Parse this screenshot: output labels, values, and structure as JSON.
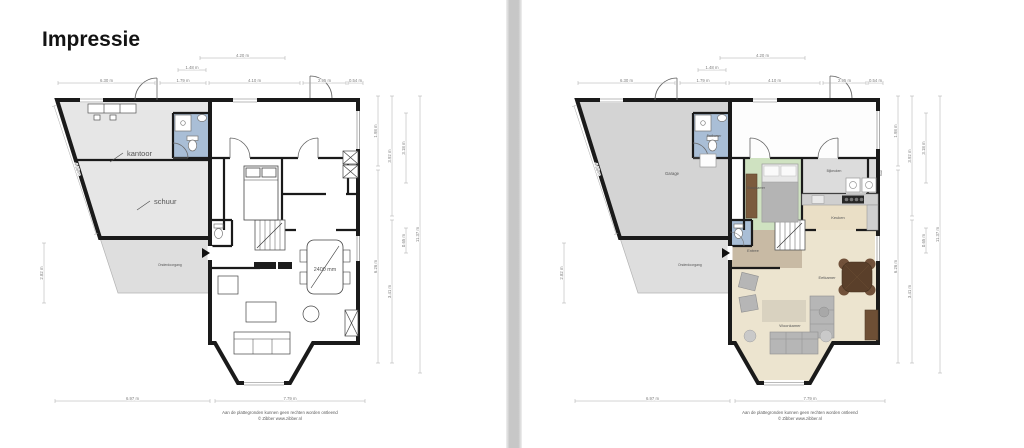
{
  "title": "Impressie",
  "footer": {
    "line1": "Aan de plattegronden kunnen geen rechten worden ontleend",
    "line2": "© Zibber www.zibber.nl"
  },
  "colors": {
    "wall": "#1a1a1a",
    "bathroom_blue": "#a9bed6",
    "bedroom_green": "#cfe2c1",
    "garage_gray": "#d4d4d4",
    "wing_gray_bw": "#e6e6e6",
    "utility_gray": "#dcdcdc",
    "kitchen_beige": "#eadfc6",
    "living_beige": "#ece4cf",
    "entree_taupe": "#c8baa4",
    "underpass_gray": "#dedede",
    "wood_brown": "#5a3f2a"
  },
  "plans": {
    "left": {
      "style": "black-and-white",
      "labels": [
        {
          "text": "kantoor",
          "x": 97,
          "y": 108,
          "size": 7.5,
          "color": "#333",
          "leader": [
            80,
            114,
            93,
            105
          ]
        },
        {
          "text": "schuur",
          "x": 124,
          "y": 156,
          "size": 7.5,
          "color": "#333",
          "leader": [
            107,
            162,
            120,
            153
          ]
        },
        {
          "text": "Onderdoorgang",
          "x": 128,
          "y": 218,
          "size": 3.4,
          "color": "#8a8a8a"
        },
        {
          "text": "2400 mm",
          "x": 295,
          "y": 223,
          "size": 5.4,
          "color": "#444",
          "anchor": "middle"
        }
      ],
      "dimensions": [
        {
          "x1": 170,
          "y1": 10,
          "x2": 255,
          "y2": 10,
          "label": "4.20 m"
        },
        {
          "x1": 148,
          "y1": 22,
          "x2": 176,
          "y2": 22,
          "label": "1.48 m"
        },
        {
          "x1": 28,
          "y1": 35,
          "x2": 125,
          "y2": 35,
          "label": "6.30 m"
        },
        {
          "x1": 130,
          "y1": 35,
          "x2": 176,
          "y2": 35,
          "label": "1.79 m"
        },
        {
          "x1": 179,
          "y1": 35,
          "x2": 270,
          "y2": 35,
          "label": "4.10 m"
        },
        {
          "x1": 273,
          "y1": 35,
          "x2": 316,
          "y2": 35,
          "label": "2.95 m"
        },
        {
          "x1": 318,
          "y1": 35,
          "x2": 333,
          "y2": 35,
          "label": "0.54 m"
        },
        {
          "x1": 25,
          "y1": 353,
          "x2": 180,
          "y2": 353,
          "label": "6.97 m"
        },
        {
          "x1": 185,
          "y1": 353,
          "x2": 335,
          "y2": 353,
          "label": "7.79 m"
        },
        {
          "x1": 348,
          "y1": 48,
          "x2": 348,
          "y2": 118,
          "label": "1.98 m"
        },
        {
          "x1": 348,
          "y1": 122,
          "x2": 348,
          "y2": 315,
          "label": "6.26 m"
        },
        {
          "x1": 362,
          "y1": 48,
          "x2": 362,
          "y2": 168,
          "label": "3.92 m"
        },
        {
          "x1": 362,
          "y1": 172,
          "x2": 362,
          "y2": 315,
          "label": "3.41 m"
        },
        {
          "x1": 376,
          "y1": 65,
          "x2": 376,
          "y2": 135,
          "label": "3.18 m"
        },
        {
          "x1": 376,
          "y1": 180,
          "x2": 376,
          "y2": 205,
          "label": "0.65 m"
        },
        {
          "x1": 390,
          "y1": 48,
          "x2": 390,
          "y2": 325,
          "label": "11.37 m"
        },
        {
          "x1": 24,
          "y1": 58,
          "x2": 66,
          "y2": 186,
          "label": "4.98 m"
        },
        {
          "x1": 14,
          "y1": 195,
          "x2": 14,
          "y2": 255,
          "label": "2.82 m"
        }
      ]
    },
    "right": {
      "style": "colored",
      "labels": [
        {
          "text": "Garage",
          "x": 122,
          "y": 127,
          "size": 4.2,
          "color": "#555",
          "anchor": "middle"
        },
        {
          "text": "Badkamer",
          "x": 164,
          "y": 89,
          "size": 3.2,
          "color": "#555",
          "anchor": "middle"
        },
        {
          "text": "Slaapkamer",
          "x": 206,
          "y": 141,
          "size": 3.4,
          "color": "#555",
          "anchor": "middle"
        },
        {
          "text": "Bijkeuken",
          "x": 284,
          "y": 124,
          "size": 3.4,
          "color": "#555",
          "anchor": "middle"
        },
        {
          "text": "Kast",
          "x": 332,
          "y": 125,
          "size": 3.0,
          "color": "#555",
          "anchor": "middle",
          "rot": -90
        },
        {
          "text": "Keuken",
          "x": 288,
          "y": 171,
          "size": 4.0,
          "color": "#555",
          "anchor": "middle"
        },
        {
          "text": "Entree",
          "x": 203,
          "y": 204,
          "size": 4.0,
          "color": "#555",
          "anchor": "middle"
        },
        {
          "text": "Eetkamer",
          "x": 277,
          "y": 231,
          "size": 4.0,
          "color": "#555",
          "anchor": "middle"
        },
        {
          "text": "Woonkamer",
          "x": 240,
          "y": 279,
          "size": 4.0,
          "color": "#555",
          "anchor": "middle"
        },
        {
          "text": "Onderdoorgang",
          "x": 128,
          "y": 218,
          "size": 3.4,
          "color": "#8a8a8a"
        }
      ],
      "dimensions": [
        {
          "x1": 170,
          "y1": 10,
          "x2": 255,
          "y2": 10,
          "label": "4.20 m"
        },
        {
          "x1": 148,
          "y1": 22,
          "x2": 176,
          "y2": 22,
          "label": "1.48 m"
        },
        {
          "x1": 28,
          "y1": 35,
          "x2": 125,
          "y2": 35,
          "label": "6.30 m"
        },
        {
          "x1": 130,
          "y1": 35,
          "x2": 176,
          "y2": 35,
          "label": "1.79 m"
        },
        {
          "x1": 179,
          "y1": 35,
          "x2": 270,
          "y2": 35,
          "label": "4.10 m"
        },
        {
          "x1": 273,
          "y1": 35,
          "x2": 316,
          "y2": 35,
          "label": "2.95 m"
        },
        {
          "x1": 318,
          "y1": 35,
          "x2": 333,
          "y2": 35,
          "label": "0.54 m"
        },
        {
          "x1": 25,
          "y1": 353,
          "x2": 180,
          "y2": 353,
          "label": "6.97 m"
        },
        {
          "x1": 185,
          "y1": 353,
          "x2": 335,
          "y2": 353,
          "label": "7.79 m"
        },
        {
          "x1": 348,
          "y1": 48,
          "x2": 348,
          "y2": 118,
          "label": "1.98 m"
        },
        {
          "x1": 348,
          "y1": 122,
          "x2": 348,
          "y2": 315,
          "label": "6.26 m"
        },
        {
          "x1": 362,
          "y1": 48,
          "x2": 362,
          "y2": 168,
          "label": "3.92 m"
        },
        {
          "x1": 362,
          "y1": 172,
          "x2": 362,
          "y2": 315,
          "label": "3.41 m"
        },
        {
          "x1": 376,
          "y1": 65,
          "x2": 376,
          "y2": 135,
          "label": "3.18 m"
        },
        {
          "x1": 376,
          "y1": 180,
          "x2": 376,
          "y2": 205,
          "label": "0.65 m"
        },
        {
          "x1": 390,
          "y1": 48,
          "x2": 390,
          "y2": 325,
          "label": "11.37 m"
        },
        {
          "x1": 24,
          "y1": 58,
          "x2": 66,
          "y2": 186,
          "label": "4.98 m"
        },
        {
          "x1": 14,
          "y1": 195,
          "x2": 14,
          "y2": 255,
          "label": "2.82 m"
        }
      ]
    }
  }
}
